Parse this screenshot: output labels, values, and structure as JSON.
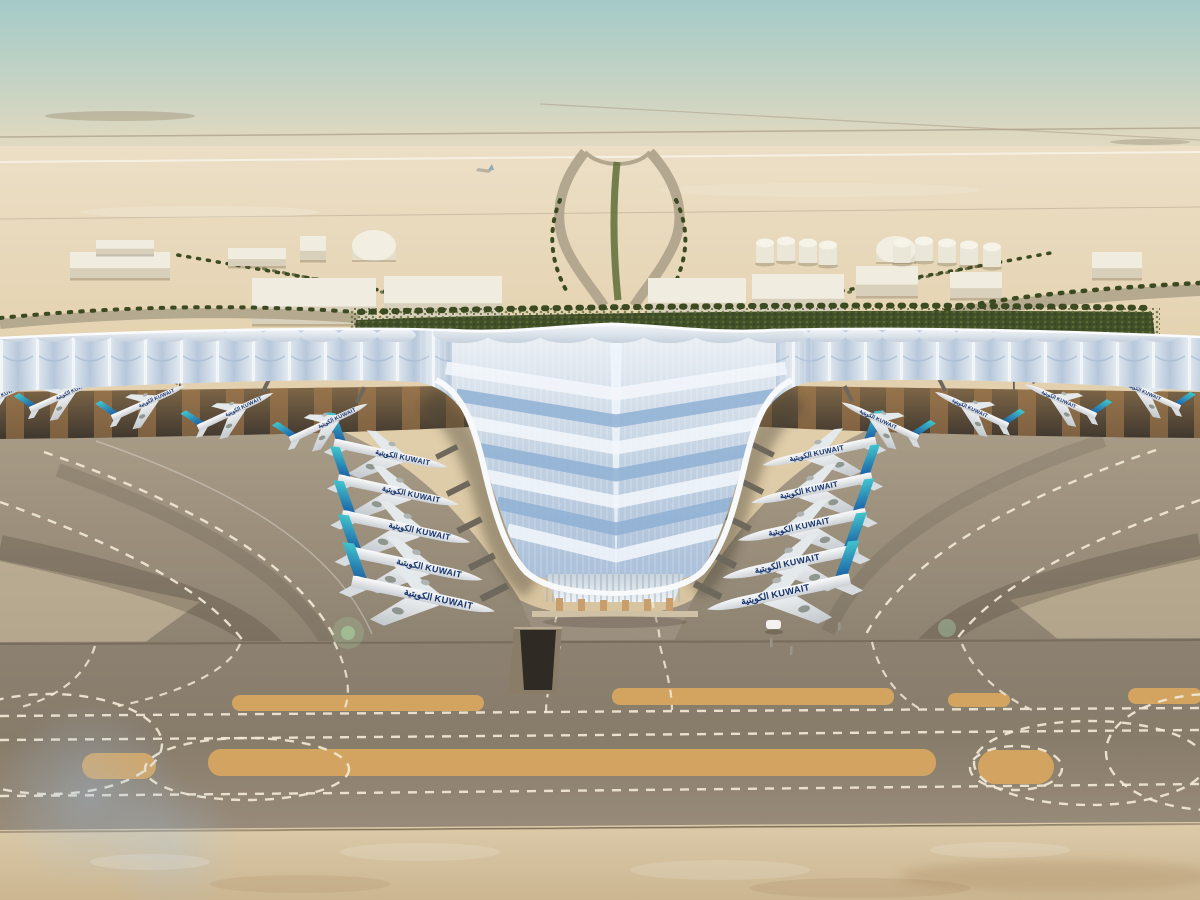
{
  "airline": {
    "label": "KUWAIT",
    "arabic_label": "الكويتية",
    "title_full": "الكويتية KUWAIT",
    "title_color": "#16356e",
    "tail_teal": "#41c6cd",
    "tail_blue": "#1956a2"
  },
  "palette": {
    "sky_top": "#a4cac8",
    "sky_haze": "#e7dcc3",
    "desert_far": "#ecdfc6",
    "desert": "#e4d2b0",
    "green_band": "#42502a",
    "palm": "#55632f",
    "roof_light": "#eef2f6",
    "roof_blue": "#a8bed9",
    "roof_edge": "#f7f9fa",
    "soffit_dark": "#3e362d",
    "soffit_amber": "#a67c4e",
    "apron": "#a89c87",
    "apron_dark": "#8d8270",
    "taxiway": "#8d8171",
    "taxiway_sand": "#d9a75f",
    "marking": "#f1e9d6",
    "sand_foreground": "#d9c6a5",
    "glass": "#dbe4ec",
    "column": "#c79e6c",
    "building": "#f0ece0",
    "fuselage": "#ffffff"
  },
  "aircraft": {
    "groups": {
      "left_v": [
        {
          "x": 334,
          "y": 443,
          "s": 0.92,
          "r": 12,
          "f": 1
        },
        {
          "x": 338,
          "y": 479,
          "s": 0.98,
          "r": 12,
          "f": 1
        },
        {
          "x": 342,
          "y": 515,
          "s": 1.04,
          "r": 12,
          "f": 1
        },
        {
          "x": 347,
          "y": 551,
          "s": 1.1,
          "r": 12,
          "f": 1
        },
        {
          "x": 352,
          "y": 581,
          "s": 1.16,
          "r": 12,
          "f": 1
        }
      ],
      "right_v": [
        {
          "x": 876,
          "y": 441,
          "s": 0.92,
          "r": -12,
          "f": -1
        },
        {
          "x": 872,
          "y": 477,
          "s": 0.98,
          "r": -12,
          "f": -1
        },
        {
          "x": 866,
          "y": 513,
          "s": 1.04,
          "r": -12,
          "f": -1
        },
        {
          "x": 858,
          "y": 549,
          "s": 1.1,
          "r": -12,
          "f": -1
        },
        {
          "x": 850,
          "y": 579,
          "s": 1.16,
          "r": -12,
          "f": -1
        }
      ],
      "left_pier": [
        {
          "x": -40,
          "y": 414,
          "s": 0.62,
          "r": -24,
          "f": 1
        },
        {
          "x": 30,
          "y": 410,
          "s": 0.62,
          "r": -24,
          "f": 1
        },
        {
          "x": 112,
          "y": 418,
          "s": 0.64,
          "r": -24,
          "f": 1
        },
        {
          "x": 198,
          "y": 428,
          "s": 0.66,
          "r": -25,
          "f": 1
        },
        {
          "x": 290,
          "y": 440,
          "s": 0.68,
          "r": -25,
          "f": 1
        }
      ],
      "right_pier": [
        {
          "x": 1240,
          "y": 402,
          "s": 0.58,
          "r": 24,
          "f": -1
        },
        {
          "x": 1180,
          "y": 408,
          "s": 0.6,
          "r": 24,
          "f": -1
        },
        {
          "x": 1096,
          "y": 416,
          "s": 0.62,
          "r": 24,
          "f": -1
        },
        {
          "x": 1008,
          "y": 426,
          "s": 0.64,
          "r": 25,
          "f": -1
        },
        {
          "x": 918,
          "y": 438,
          "s": 0.67,
          "r": 25,
          "f": -1
        }
      ]
    }
  },
  "distant": {
    "buildings": [
      {
        "t": "box",
        "x": 70,
        "y": 252,
        "w": 100,
        "h": 26
      },
      {
        "t": "box",
        "x": 96,
        "y": 240,
        "w": 58,
        "h": 14
      },
      {
        "t": "box",
        "x": 228,
        "y": 248,
        "w": 58,
        "h": 18
      },
      {
        "t": "box",
        "x": 300,
        "y": 236,
        "w": 26,
        "h": 24
      },
      {
        "t": "dome",
        "x": 352,
        "y": 230,
        "w": 44,
        "h": 30
      },
      {
        "t": "shed",
        "x": 252,
        "y": 278,
        "w": 124,
        "h": 46
      },
      {
        "t": "shed",
        "x": 384,
        "y": 276,
        "w": 118,
        "h": 44
      },
      {
        "t": "shed",
        "x": 648,
        "y": 278,
        "w": 98,
        "h": 40
      },
      {
        "t": "shed",
        "x": 752,
        "y": 274,
        "w": 92,
        "h": 40
      },
      {
        "t": "box",
        "x": 856,
        "y": 266,
        "w": 62,
        "h": 30
      },
      {
        "t": "dome",
        "x": 876,
        "y": 236,
        "w": 40,
        "h": 26
      },
      {
        "t": "box",
        "x": 950,
        "y": 272,
        "w": 52,
        "h": 26
      },
      {
        "t": "box",
        "x": 1092,
        "y": 252,
        "w": 50,
        "h": 26
      }
    ],
    "fuel_tanks": [
      {
        "x": 756,
        "y": 238
      },
      {
        "x": 777,
        "y": 236
      },
      {
        "x": 799,
        "y": 238
      },
      {
        "x": 819,
        "y": 240
      },
      {
        "x": 893,
        "y": 238
      },
      {
        "x": 915,
        "y": 236
      },
      {
        "x": 938,
        "y": 238
      },
      {
        "x": 960,
        "y": 240
      },
      {
        "x": 983,
        "y": 242
      }
    ]
  },
  "taxiway": {
    "sand_strips": [
      {
        "x": 232,
        "y": 695,
        "w": 252,
        "h": 16,
        "r": 8
      },
      {
        "x": 612,
        "y": 688,
        "w": 282,
        "h": 17,
        "r": 8
      },
      {
        "x": 948,
        "y": 693,
        "w": 62,
        "h": 14,
        "r": 7
      },
      {
        "x": 1128,
        "y": 688,
        "w": 74,
        "h": 16,
        "r": 8
      },
      {
        "x": 82,
        "y": 753,
        "w": 74,
        "h": 26,
        "r": 13
      },
      {
        "x": 208,
        "y": 749,
        "w": 728,
        "h": 27,
        "r": 13
      },
      {
        "x": 978,
        "y": 750,
        "w": 76,
        "h": 34,
        "r": 17
      }
    ]
  }
}
